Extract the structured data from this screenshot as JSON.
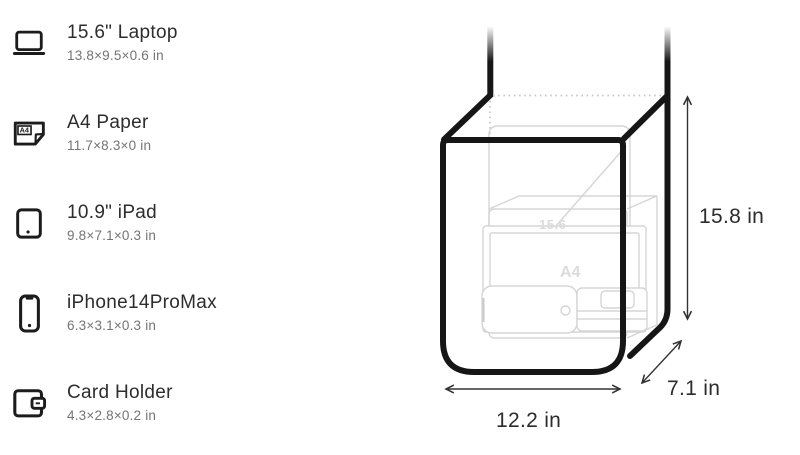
{
  "page": {
    "background": "#ffffff"
  },
  "item_list": {
    "items": [
      {
        "icon": "laptop-icon",
        "name": "15.6\" Laptop",
        "dimensions": "13.8×9.5×0.6 in"
      },
      {
        "icon": "a4-paper-icon",
        "name": "A4 Paper",
        "dimensions": "11.7×8.3×0 in"
      },
      {
        "icon": "ipad-icon",
        "name": "10.9\" iPad",
        "dimensions": "9.8×7.1×0.3 in"
      },
      {
        "icon": "iphone-icon",
        "name": "iPhone14ProMax",
        "dimensions": "6.3×3.1×0.3 in"
      },
      {
        "icon": "card-holder-icon",
        "name": "Card Holder",
        "dimensions": "4.3×2.8×0.2 in"
      }
    ]
  },
  "bag_diagram": {
    "height_label": "15.8 in",
    "depth_label": "7.1 in",
    "width_label": "12.2 in",
    "ghost_items": {
      "laptop_label": "15.6",
      "paper_label": "A4"
    }
  },
  "colors": {
    "outline": "#161616",
    "ghost": "#d5d5d5",
    "dotted": "#c6c6c6",
    "title_text": "#2d2d2d",
    "subtitle_text": "#747474",
    "dimension_text": "#2c2c2c"
  }
}
